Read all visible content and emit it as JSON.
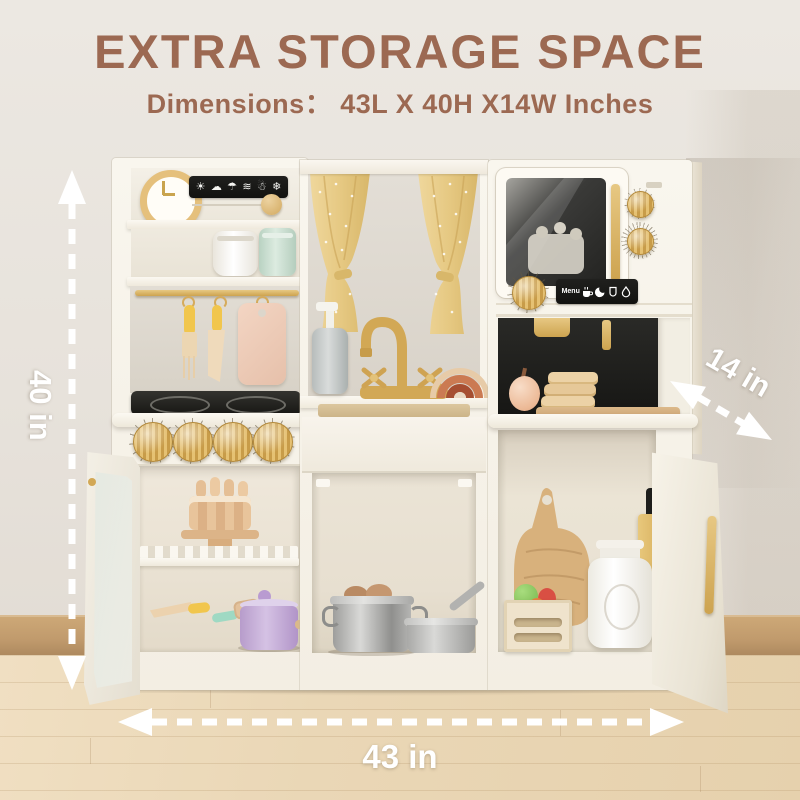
{
  "header": {
    "title": "EXTRA STORAGE SPACE",
    "subtitle": "Dimensions：  43L X 40H X14W Inches",
    "text_color": "#9c6952"
  },
  "dimension_labels": {
    "height": "40 in",
    "depth": "14 in",
    "width": "43 in",
    "color": "#ffffff"
  },
  "appliance_labels": {
    "coffee_menu": "Menu"
  },
  "icons": {
    "weather_names": [
      "sun-icon",
      "cloud-icon",
      "rain-cloud-icon",
      "wind-icon",
      "snow-cloud-icon",
      "snowflake-icon"
    ],
    "weather_glyphs": [
      "☀",
      "☁",
      "☂",
      "≋",
      "☃",
      "❄"
    ],
    "coffee_names": [
      "coffee-cup-icon",
      "croissant-icon",
      "tea-cup-icon",
      "water-drop-icon"
    ]
  },
  "palette": {
    "wall": "#e9e4de",
    "floor_wood": "#ead7b6",
    "skirting_wood": "#c09a6c",
    "cabinet_cream": "#f6f2e9",
    "brass_gold": "#d2a855",
    "panel_black": "#1a1a18",
    "curtain_gold": "#e8cd8e",
    "title_brown": "#9c6952"
  }
}
